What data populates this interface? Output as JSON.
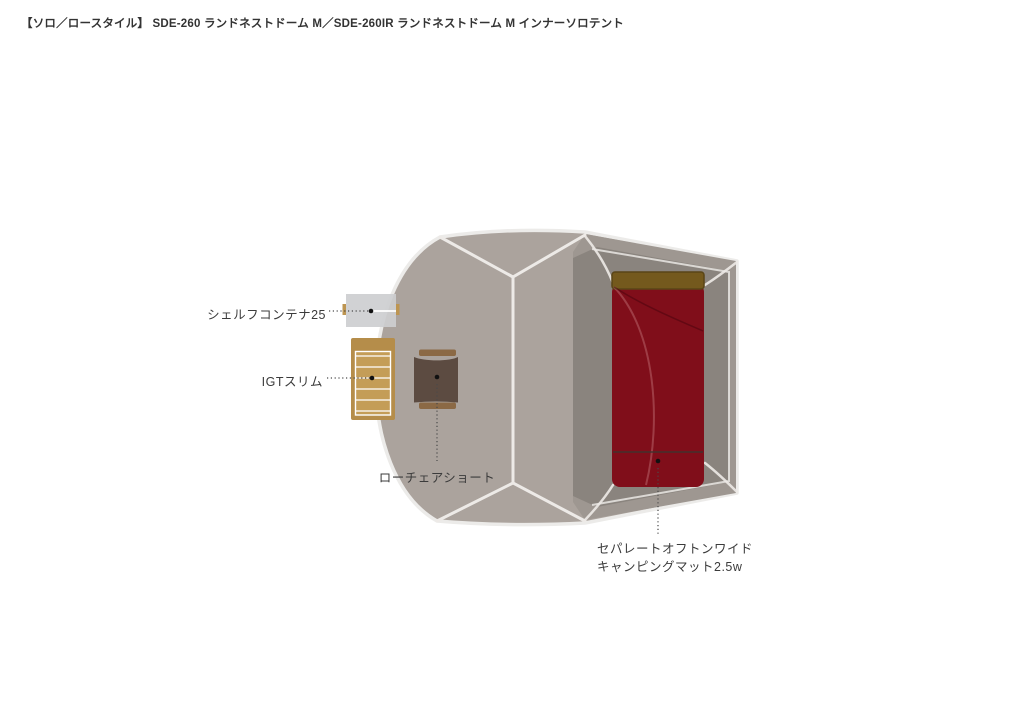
{
  "title": "【ソロ／ロースタイル】 SDE-260 ランドネストドーム M／SDE-260IR ランドネストドーム M インナーソロテント",
  "labels": {
    "shelf_container": "シェルフコンテナ25",
    "igt_slim": "IGTスリム",
    "low_chair": "ローチェアショート",
    "mat_line1": "セパレートオフトンワイド",
    "mat_line2": "キャンピングマット2.5w"
  },
  "colors": {
    "tent_body": "#aba39d",
    "inner_wall": "#9e9791",
    "inner_floor": "#8a847e",
    "seam_white": "#edeae7",
    "floor_outline": "#e9e6e3",
    "mat_red": "#800e1a",
    "mat_seam": "#3f3530",
    "pillow_brown": "#74591d",
    "pillow_edge": "#5a4517",
    "chair_body": "#5c4b41",
    "chair_armrest": "#8b6945",
    "table_frame": "#b58d4a",
    "table_slat": "#c49d57",
    "container_gray": "#cdced0",
    "container_handle": "#bd9551",
    "leader_dot": "#4a4a4a",
    "marker_dot": "#111111"
  }
}
